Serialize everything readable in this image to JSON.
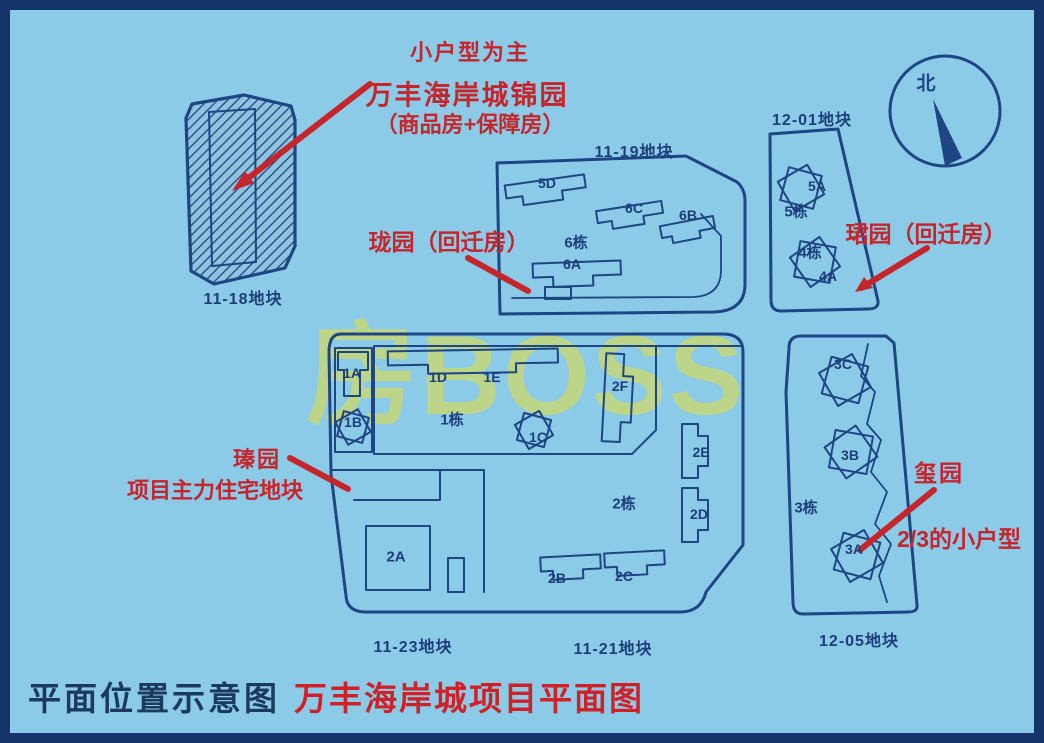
{
  "caption": {
    "left": "平面位置示意图",
    "right": "万丰海岸城项目平面图"
  },
  "watermark": {
    "text": "房BOSS"
  },
  "compass": {
    "north": "北"
  },
  "colors": {
    "background": "#8bcbe7",
    "border": "#14346a",
    "line": "#1e4584",
    "red": "#c5262c",
    "watermark": "#c8d874",
    "caption_dark": "#1c3a5e",
    "caption_red": "#cf2127"
  },
  "annotations": {
    "jinyuan_line1": "小户型为主",
    "jinyuan_line2": "万丰海岸城锦园",
    "jinyuan_line3": "（商品房+保障房）",
    "longyuan": "珑园（回迁房）",
    "junyuan": "珺园（回迁房）",
    "zhenyuan": "瑧园",
    "zhenyuan_sub": "项目主力住宅地块",
    "xiyuan": "玺园",
    "xiyuan_sub": "2/3的小户型"
  },
  "plots": {
    "p11_18": "11-18地块",
    "p11_19": "11-19地块",
    "p12_01": "12-01地块",
    "p11_23": "11-23地块",
    "p11_21": "11-21地块",
    "p12_05": "12-05地块"
  },
  "buildings": {
    "b5D": "5D",
    "b6C": "6C",
    "b6B": "6B",
    "b6dong": "6栋",
    "b6A": "6A",
    "b5A": "5A",
    "b5dong": "5栋",
    "b4dong": "4栋",
    "b4A": "4A",
    "b1A": "1A",
    "b1B": "1B",
    "b1D": "1D",
    "b1E": "1E",
    "b1dong": "1栋",
    "b1C": "1C",
    "b2F": "2F",
    "b2E": "2E",
    "b2dong": "2栋",
    "b2D": "2D",
    "b2A": "2A",
    "b2B": "2B",
    "b2C": "2C",
    "b3C": "3C",
    "b3B": "3B",
    "b3dong": "3栋",
    "b3A": "3A"
  }
}
